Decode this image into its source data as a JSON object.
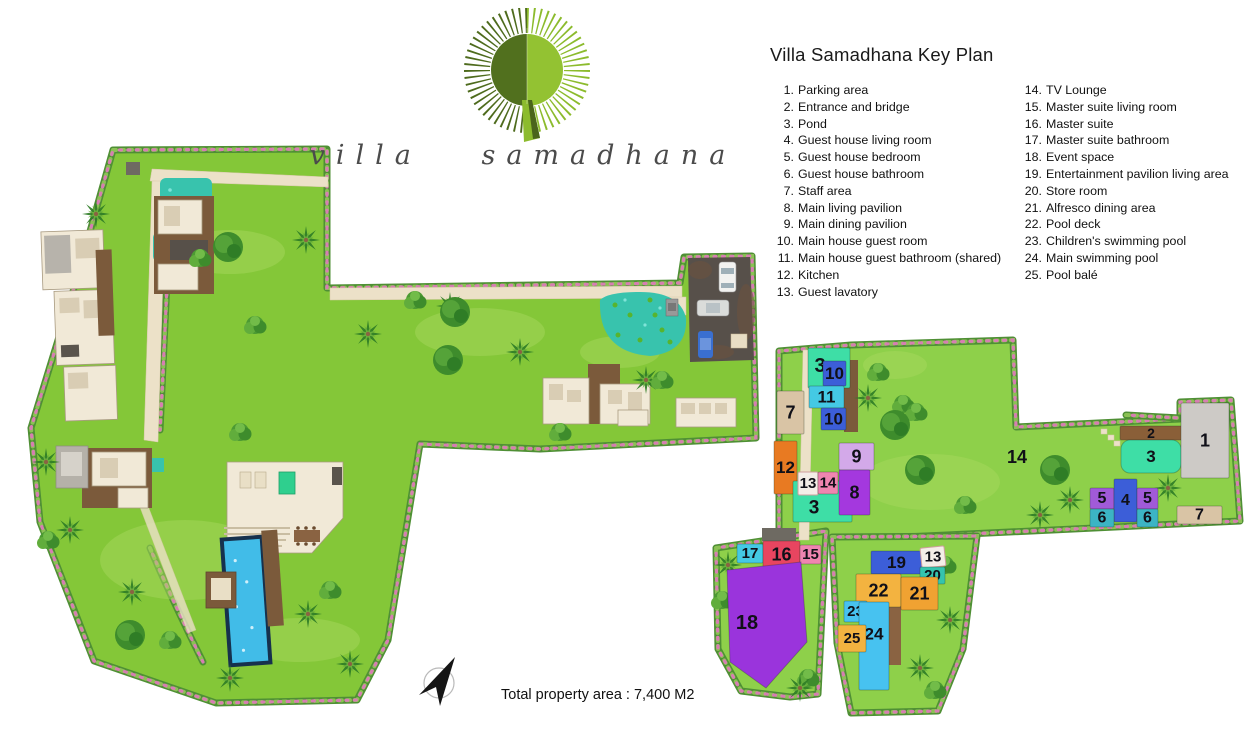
{
  "logo": {
    "wordmark": "villa samadhana"
  },
  "legend": {
    "title": "Villa Samadhana Key Plan",
    "columns": [
      {
        "items": [
          {
            "num": "1.",
            "label": "Parking area"
          },
          {
            "num": "2.",
            "label": "Entrance and bridge"
          },
          {
            "num": "3.",
            "label": "Pond"
          },
          {
            "num": "4.",
            "label": "Guest house living room"
          },
          {
            "num": "5.",
            "label": "Guest house bedroom"
          },
          {
            "num": "6.",
            "label": "Guest house bathroom"
          },
          {
            "num": "7.",
            "label": "Staff area"
          },
          {
            "num": "8.",
            "label": "Main living pavilion"
          },
          {
            "num": "9.",
            "label": "Main dining pavilion"
          },
          {
            "num": "10.",
            "label": "Main house guest room"
          },
          {
            "num": "11.",
            "label": "Main house guest bathroom (shared)"
          },
          {
            "num": "12.",
            "label": "Kitchen"
          },
          {
            "num": "13.",
            "label": "Guest lavatory"
          }
        ]
      },
      {
        "items": [
          {
            "num": "14.",
            "label": "TV Lounge"
          },
          {
            "num": "15.",
            "label": "Master suite living room"
          },
          {
            "num": "16.",
            "label": "Master suite"
          },
          {
            "num": "17.",
            "label": "Master suite bathroom"
          },
          {
            "num": "18.",
            "label": "Event space"
          },
          {
            "num": "19.",
            "label": "Entertainment pavilion living area"
          },
          {
            "num": "20.",
            "label": "Store room"
          },
          {
            "num": "21.",
            "label": "Alfresco dining area"
          },
          {
            "num": "22.",
            "label": "Pool deck"
          },
          {
            "num": "23.",
            "label": "Children's swimming pool"
          },
          {
            "num": "24.",
            "label": "Main swimming pool"
          },
          {
            "num": "25.",
            "label": "Pool balé"
          }
        ]
      }
    ]
  },
  "footer": {
    "total_area": "Total property area : 7,400 M2"
  },
  "palette": {
    "mint": "#3edea6",
    "blue": "#3c5ed8",
    "cyan": "#44c9e4",
    "tan": "#d9c4a5",
    "orange": "#e87a22",
    "white": "#f4eee8",
    "pink": "#ef85b0",
    "lavender": "#d3a9e9",
    "purple": "#a438de",
    "purple18": "#9a34dc",
    "violet": "#a15ad8",
    "crimson": "#e84560",
    "amber": "#f3b340",
    "amber2": "#f0a232",
    "sky": "#47c2f0",
    "gray": "#cdcac6",
    "brown": "#8a5f38",
    "teal20": "#35c4ae",
    "teal6": "#3cb4c4",
    "none": "none"
  },
  "site_blocks": [
    {
      "n": "3",
      "x": 808,
      "y": 348,
      "w": 42,
      "h": 40,
      "c": "mint",
      "fs": 20,
      "tx": 820,
      "ty": 366
    },
    {
      "n": "10",
      "x": 823,
      "y": 361,
      "w": 23,
      "h": 25,
      "c": "blue",
      "fs": 17
    },
    {
      "n": "11",
      "x": 809,
      "y": 386,
      "w": 35,
      "h": 22,
      "c": "cyan",
      "fs": 17
    },
    {
      "n": "10",
      "x": 821,
      "y": 408,
      "w": 25,
      "h": 22,
      "c": "blue",
      "fs": 17
    },
    {
      "n": "7",
      "x": 777,
      "y": 391,
      "w": 27,
      "h": 43,
      "c": "tan",
      "fs": 18
    },
    {
      "n": "12",
      "x": 774,
      "y": 441,
      "w": 23,
      "h": 53,
      "c": "orange",
      "fs": 17
    },
    {
      "n": "3",
      "x": 793,
      "y": 481,
      "w": 59,
      "h": 41,
      "c": "mint",
      "fs": 19,
      "tx": 814,
      "ty": 508
    },
    {
      "n": "13",
      "x": 798,
      "y": 472,
      "w": 20,
      "h": 23,
      "c": "white",
      "fs": 15
    },
    {
      "n": "14",
      "x": 818,
      "y": 472,
      "w": 20,
      "h": 22,
      "c": "pink",
      "fs": 15
    },
    {
      "n": "9",
      "x": 839,
      "y": 443,
      "w": 35,
      "h": 27,
      "c": "lavender",
      "fs": 18
    },
    {
      "n": "8",
      "x": 839,
      "y": 470,
      "w": 31,
      "h": 45,
      "c": "purple",
      "fs": 18
    },
    {
      "n": "2",
      "x": 1120,
      "y": 426,
      "w": 62,
      "h": 14,
      "c": "brown",
      "fs": 14
    },
    {
      "n": "3",
      "x": 1121,
      "y": 440,
      "w": 60,
      "h": 33,
      "c": "mint",
      "fs": 17,
      "rx": 9
    },
    {
      "n": "1",
      "x": 1181,
      "y": 403,
      "w": 48,
      "h": 75,
      "c": "gray",
      "fs": 18
    },
    {
      "n": "14",
      "x": 1002,
      "y": 447,
      "w": 30,
      "h": 20,
      "c": "none",
      "fs": 18
    },
    {
      "n": "5",
      "x": 1090,
      "y": 488,
      "w": 24,
      "h": 21,
      "c": "violet",
      "fs": 16
    },
    {
      "n": "4",
      "x": 1114,
      "y": 479,
      "w": 23,
      "h": 43,
      "c": "blue",
      "fs": 16
    },
    {
      "n": "5",
      "x": 1137,
      "y": 488,
      "w": 21,
      "h": 21,
      "c": "violet",
      "fs": 16
    },
    {
      "n": "6",
      "x": 1090,
      "y": 509,
      "w": 24,
      "h": 18,
      "c": "teal6",
      "fs": 16
    },
    {
      "n": "6",
      "x": 1137,
      "y": 509,
      "w": 21,
      "h": 18,
      "c": "teal6",
      "fs": 16
    },
    {
      "n": "7",
      "x": 1177,
      "y": 506,
      "w": 45,
      "h": 18,
      "c": "tan",
      "fs": 16
    },
    {
      "n": "17",
      "x": 737,
      "y": 544,
      "w": 26,
      "h": 19,
      "c": "cyan",
      "fs": 15
    },
    {
      "n": "16",
      "x": 763,
      "y": 541,
      "w": 37,
      "h": 27,
      "c": "crimson",
      "fs": 18
    },
    {
      "n": "15",
      "x": 800,
      "y": 545,
      "w": 21,
      "h": 19,
      "c": "pink",
      "fs": 15
    },
    {
      "n": "18",
      "poly": "727,570 801,562 807,642 766,688 730,662",
      "c": "purple18",
      "fs": 20,
      "tx": 747,
      "ty": 623
    },
    {
      "n": "19",
      "x": 871,
      "y": 551,
      "w": 51,
      "h": 23,
      "c": "blue",
      "fs": 17
    },
    {
      "n": "13",
      "x": 921,
      "y": 547,
      "w": 24,
      "h": 20,
      "c": "white",
      "fs": 15,
      "r": -6
    },
    {
      "n": "20",
      "x": 920,
      "y": 567,
      "w": 25,
      "h": 17,
      "c": "teal20",
      "fs": 15
    },
    {
      "n": "22",
      "x": 856,
      "y": 574,
      "w": 45,
      "h": 33,
      "c": "amber",
      "fs": 18
    },
    {
      "n": "21",
      "x": 901,
      "y": 577,
      "w": 37,
      "h": 33,
      "c": "amber2",
      "fs": 18
    },
    {
      "n": "23",
      "x": 844,
      "y": 601,
      "w": 23,
      "h": 21,
      "c": "sky",
      "fs": 15
    },
    {
      "n": "24",
      "x": 859,
      "y": 602,
      "w": 30,
      "h": 88,
      "c": "sky",
      "fs": 17,
      "ty": 634
    },
    {
      "n": "25",
      "x": 838,
      "y": 625,
      "w": 28,
      "h": 27,
      "c": "amber",
      "fs": 15
    }
  ]
}
